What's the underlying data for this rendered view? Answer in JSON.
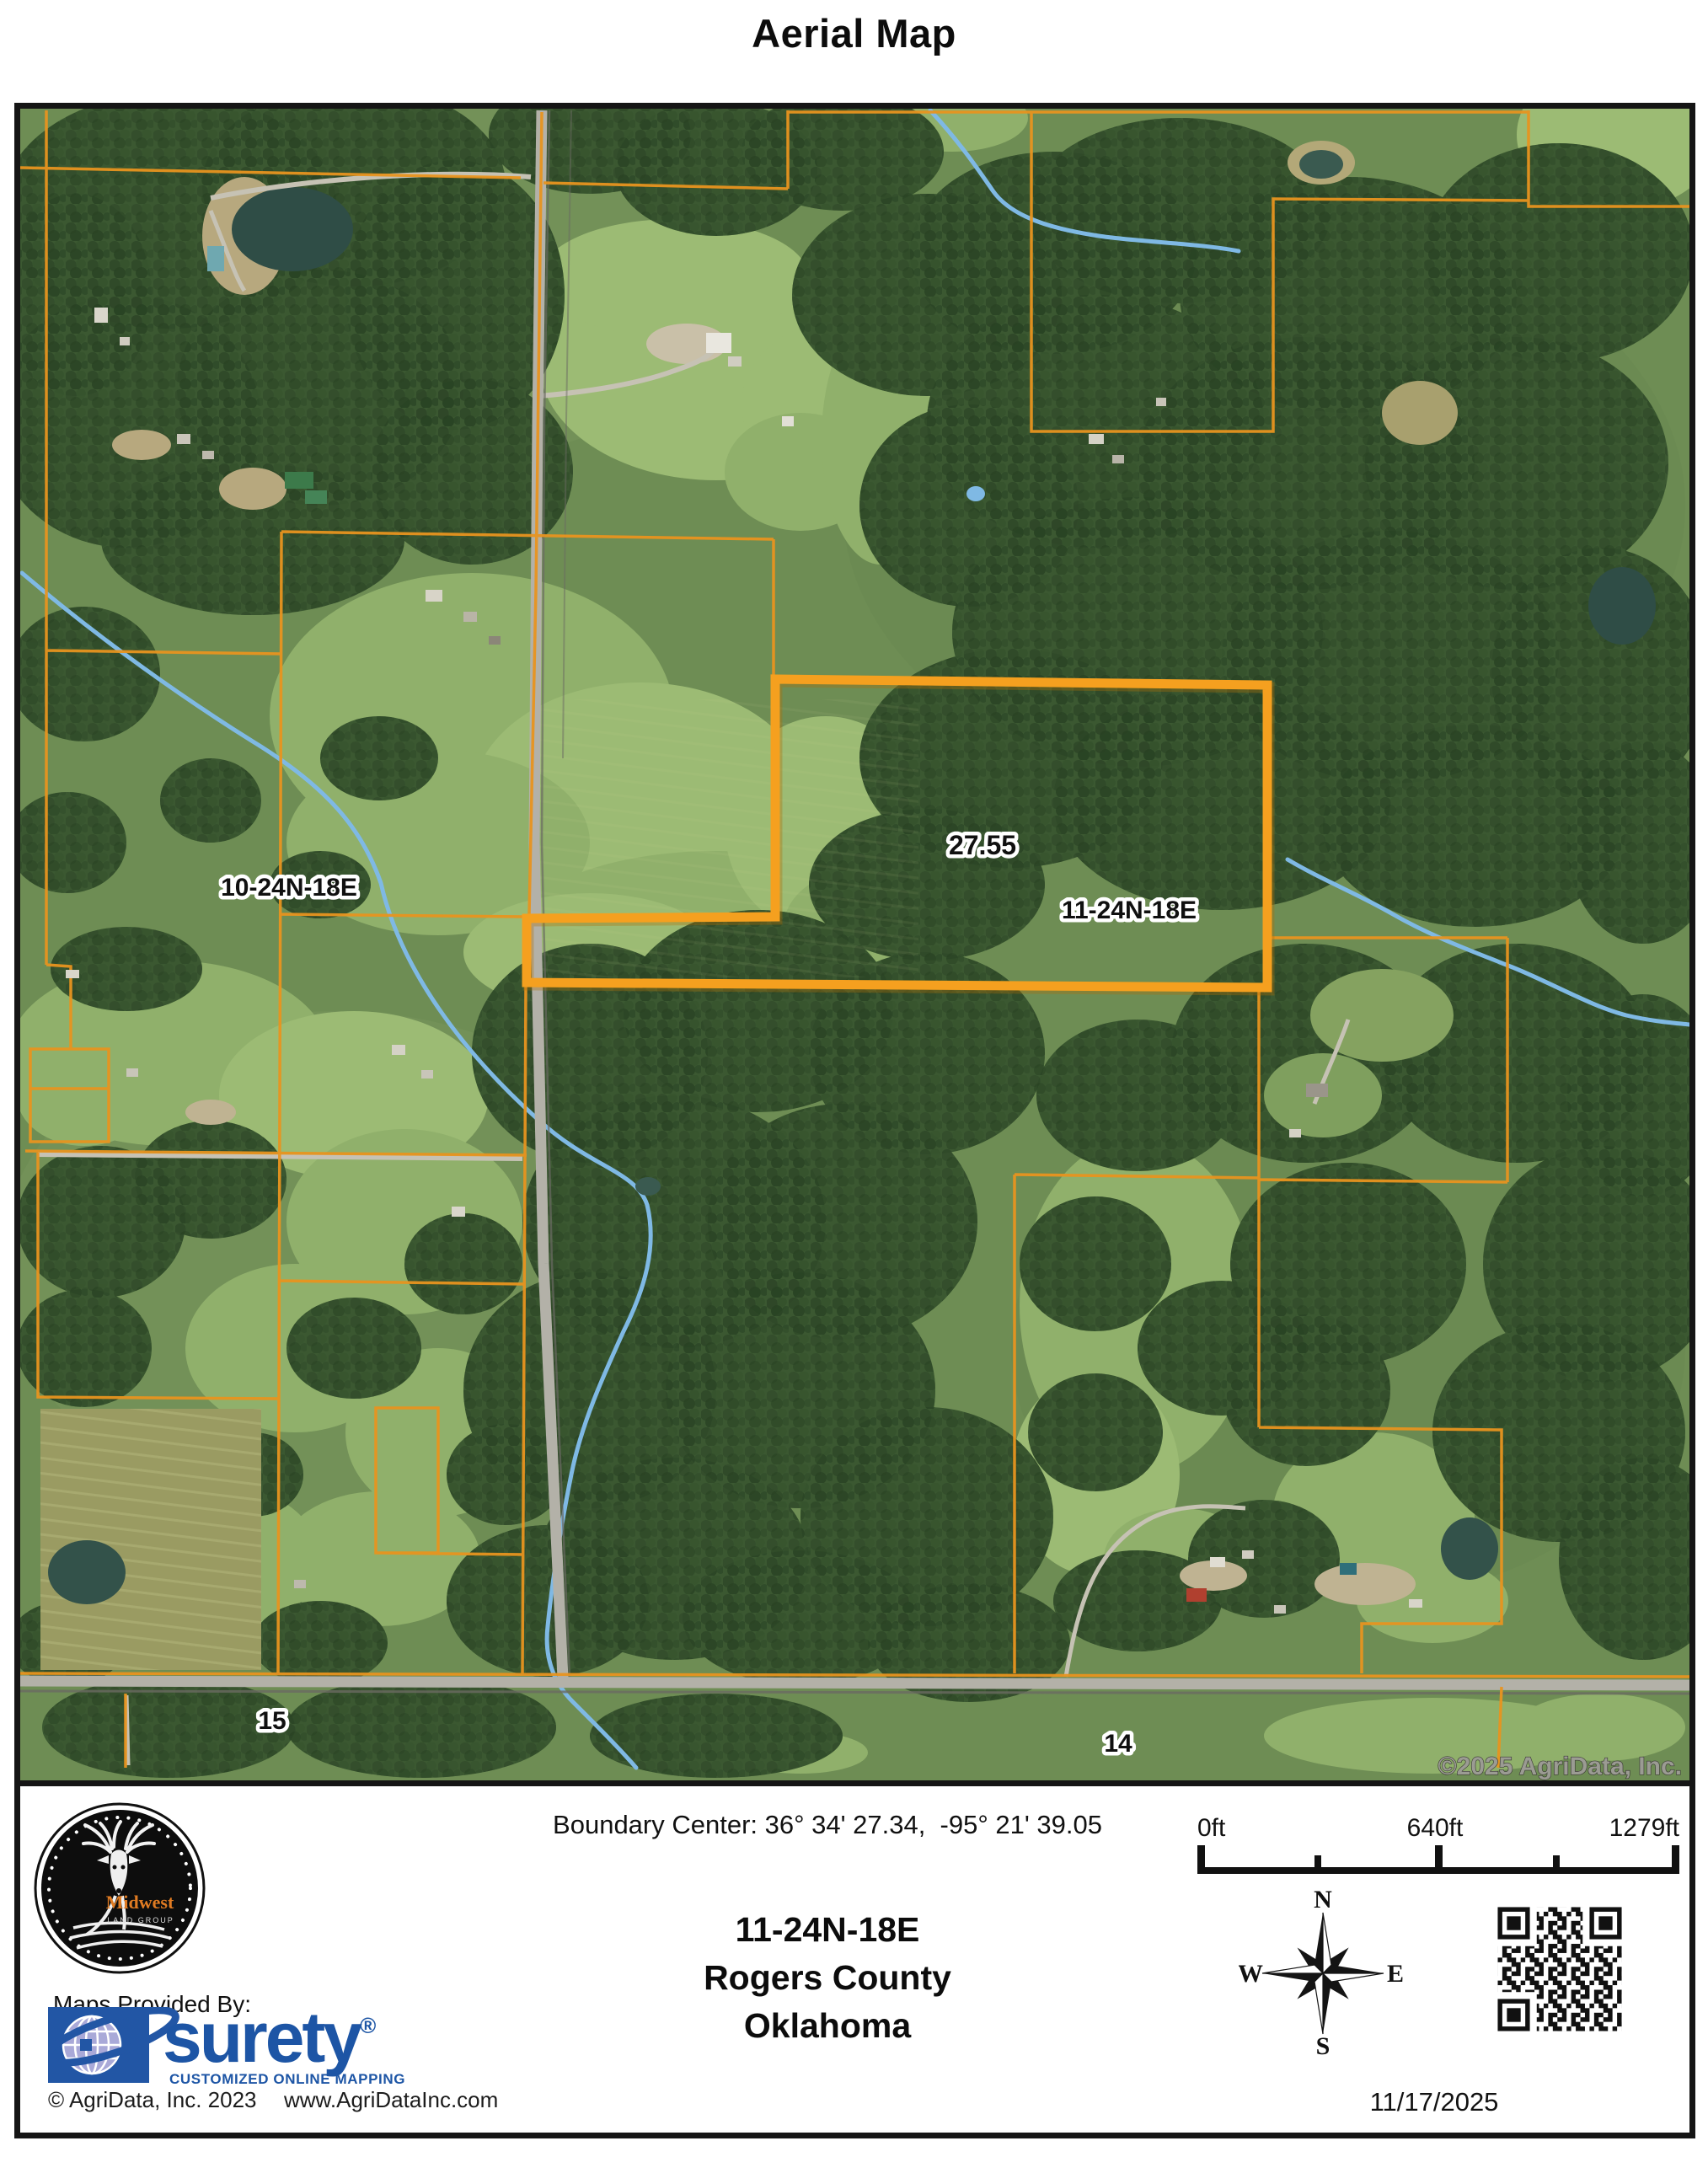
{
  "page": {
    "title": "Aerial Map"
  },
  "map": {
    "parcel_acres_label": "27.55",
    "section_label_main": "11-24N-18E",
    "section_label_nw": "10-24N-18E",
    "section_label_sw": "15",
    "section_label_se": "14",
    "copyright_overlay": "©2025 AgriData, Inc.",
    "colors": {
      "parcel_highlight": "#F5A01F",
      "parcel_boundary": "#E8941F",
      "stream": "#7FB9E4",
      "road": "#B3B1A8",
      "forest": "#3B5831",
      "pasture": "#90B06B"
    }
  },
  "footer": {
    "boundary_center": "Boundary Center: 36° 34' 27.34,  -95° 21' 39.05",
    "location": {
      "township": "11-24N-18E",
      "county": "Rogers County",
      "state": "Oklahoma"
    },
    "scale_bar": {
      "zero": "0ft",
      "mid": "640ft",
      "max": "1279ft"
    },
    "compass": {
      "north": "N",
      "south": "S",
      "east": "E",
      "west": "W"
    },
    "provider": {
      "heading": "Maps Provided By:",
      "brand": "surety",
      "registered": "®",
      "tagline": "CUSTOMIZED ONLINE MAPPING",
      "copyright": "© AgriData, Inc. 2023",
      "website": "www.AgriDataInc.com"
    },
    "logo": {
      "brand": "Midwest",
      "sub": "LAND GROUP"
    },
    "date": "11/17/2025"
  }
}
